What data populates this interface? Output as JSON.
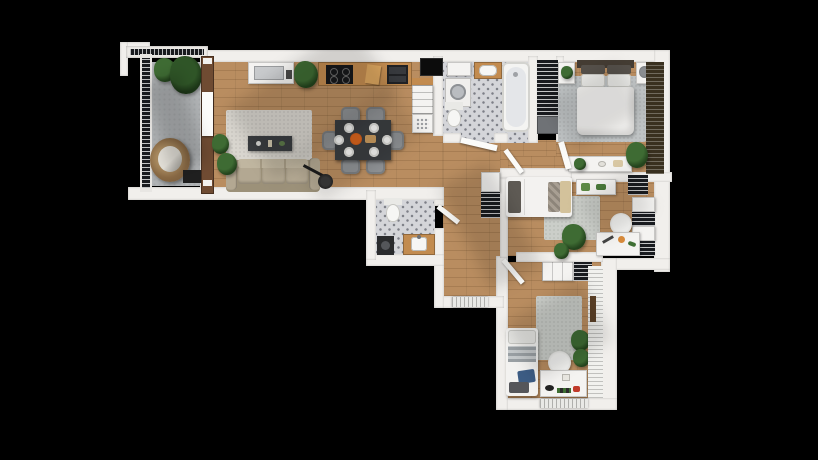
{
  "scene": {
    "description": "3D top-down rendering of an apartment floor plan on a black background",
    "background": "#000000",
    "visible_text": "none"
  },
  "palette": {
    "wall": "#f1efec",
    "wall-shade": "#d9d7d3",
    "wood": "#b98d60",
    "wood-line": "rgba(84,52,22,0.18)",
    "counter-wood": "#c28b4f",
    "tile": "#d4d5d9",
    "tile-dot": "#7d7f87",
    "concrete": "#b0b3b5",
    "rug-living": "#d9d6cf",
    "rug-gray": "#bfc3c4",
    "sofa": "#b3a892",
    "sofa-dark": "#9c9179",
    "furn-dark": "#3a3d40",
    "chair-gray": "#8f9295",
    "green": "#3e6b33",
    "green-dark": "#24441d",
    "bed-white": "#f3f2f0",
    "headboard": "#443c33",
    "pillow-gray": "#8f8d88",
    "pillow-beige": "#d3c29b",
    "pillow-blue": "#3c5c84",
    "stripe-dark": "#191b1f",
    "blinds-brown": "#39301f",
    "orange": "#d4621c",
    "rattan": "#8a6a45",
    "black": "#0c0c0c",
    "door": "#fbfbf9"
  },
  "rooms": [
    {
      "id": "balcony",
      "floor": "concrete",
      "furniture": [
        "metal-railing",
        "corner-railing-bracket",
        "potted-plants",
        "hanging-egg-chair",
        "doormat"
      ]
    },
    {
      "id": "living-room",
      "floor": "wood",
      "furniture": [
        "area-rug",
        "sofa",
        "coffee-table",
        "floor-lamp",
        "potted-plants",
        "balcony-window-door"
      ]
    },
    {
      "id": "kitchen",
      "floor": "wood",
      "furniture": [
        "sink-cabinet",
        "potted-plant",
        "cooktop-counter",
        "cutting-board",
        "double-sink",
        "fridge",
        "drawer-unit",
        "patterned-floor-unit"
      ]
    },
    {
      "id": "dining-area",
      "floor": "wood",
      "furniture": [
        "dining-table",
        "dining-chairs-x6",
        "plates-x6",
        "serving-dish"
      ]
    },
    {
      "id": "bathroom",
      "floor": "tile",
      "furniture": [
        "washing-machine",
        "wall-cabinet",
        "sink-vanity",
        "toilet",
        "bathtub",
        "door"
      ]
    },
    {
      "id": "hall-wardrobe",
      "floor": "wood",
      "furniture": [
        "open-wardrobe-shelving",
        "storage-box"
      ]
    },
    {
      "id": "master-bedroom",
      "floor": "wood",
      "furniture": [
        "double-bed",
        "headboard",
        "pillows",
        "nightstand-left",
        "nightstand-right",
        "area-rug",
        "console-table",
        "potted-plant",
        "window-blinds"
      ]
    },
    {
      "id": "hallway",
      "floor": "wood",
      "furniture": [
        "shoe-cabinet",
        "radiator",
        "interior-doors"
      ]
    },
    {
      "id": "middle-bedroom",
      "floor": "wood",
      "furniture": [
        "single-bed",
        "area-rug",
        "wall-desk",
        "bookshelf",
        "side-wardrobe",
        "desk",
        "desk-chair",
        "potted-plants"
      ]
    },
    {
      "id": "wc",
      "floor": "tile",
      "furniture": [
        "toilet",
        "washing-machine",
        "sink-vanity",
        "door"
      ]
    },
    {
      "id": "bottom-bedroom",
      "floor": "wood",
      "furniture": [
        "single-bed",
        "area-rug",
        "dresser",
        "shoe-rack",
        "desk",
        "desk-chair",
        "potted-plants",
        "louvered-wardrobe",
        "radiator"
      ]
    }
  ]
}
